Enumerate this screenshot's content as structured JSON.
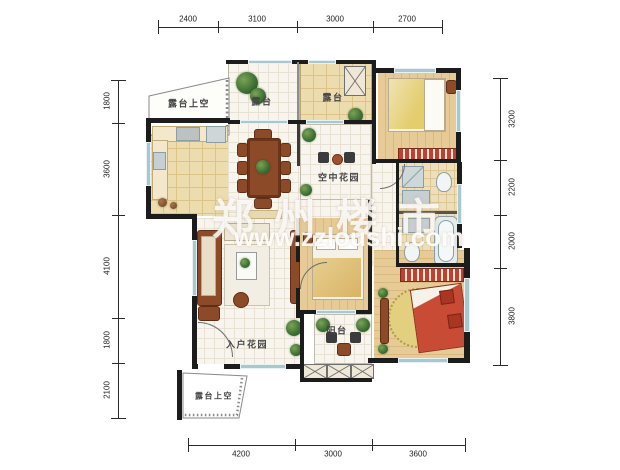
{
  "watermark": {
    "title": "郑州楼市",
    "url": "www.zzloushi.com"
  },
  "dimensions": {
    "top": [
      "2400",
      "3100",
      "3000",
      "2700"
    ],
    "bottom": [
      "4200",
      "3000",
      "3600"
    ],
    "left": [
      "1800",
      "3600",
      "4100",
      "1800",
      "2100"
    ],
    "right": [
      "3200",
      "2200",
      "2000",
      "3800"
    ]
  },
  "rooms": {
    "terrace_above_top": "露台上空",
    "terrace_left": "露台",
    "terrace_right": "露台",
    "sky_garden": "空中花园",
    "entry_garden": "入户花园",
    "balcony": "阳台",
    "terrace_above_bottom": "露台上空"
  },
  "colors": {
    "wall": "#1c1c1c",
    "wood_floor": "#e2c793",
    "tile_floor": "#f8f5ee",
    "terrace_tile": "#ecdcae",
    "window": "#a9c7cf",
    "accent_red": "#c0402f",
    "plant_green": "#3c6e33",
    "watermark": "#ffffff"
  }
}
